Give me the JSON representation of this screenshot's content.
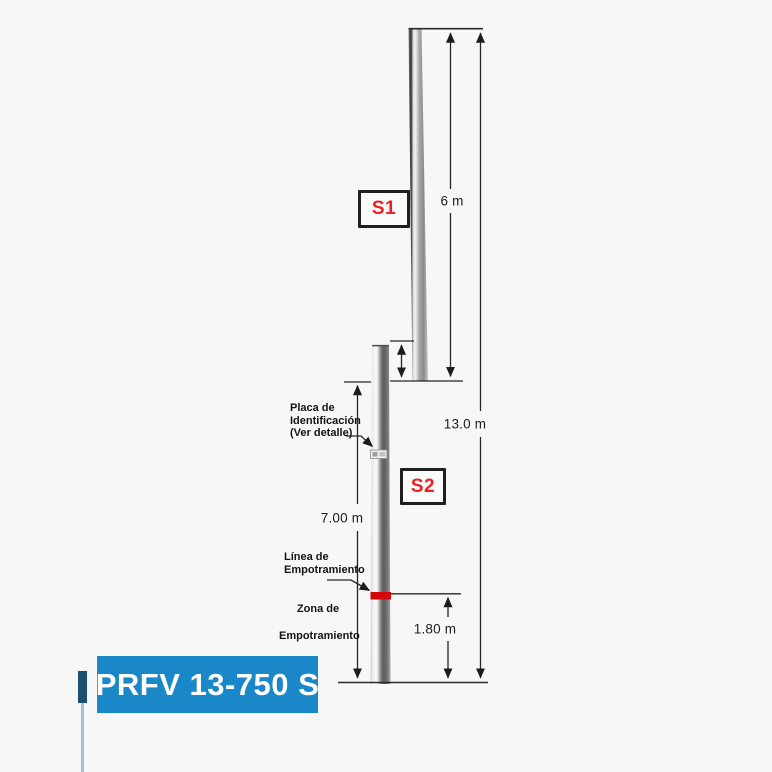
{
  "background": "#f7f7f7",
  "drawing": {
    "section_labels": {
      "s1": "S1",
      "s2": "S2"
    },
    "dimensions": {
      "s1_length": "6 m",
      "total_length": "13.0 m",
      "s2_length": "7.00 m",
      "embedment_depth": "1.80 m"
    },
    "annotations": {
      "placa": "Placa de\nIdentificación\n(Ver detalle)",
      "linea": "Línea de\nEmpotramiento",
      "zona": "Zona de\nEmpotramiento"
    },
    "colors": {
      "embedment_band_red": "#d40808",
      "section_label_red": "#ed2024",
      "line_color": "#262626",
      "banner_blue": "#1a87c8",
      "dark_accent": "#1d4f70",
      "thin_line_blue": "#a6bfce"
    }
  },
  "footer": {
    "model_label": "PRFV 13-750 S"
  }
}
